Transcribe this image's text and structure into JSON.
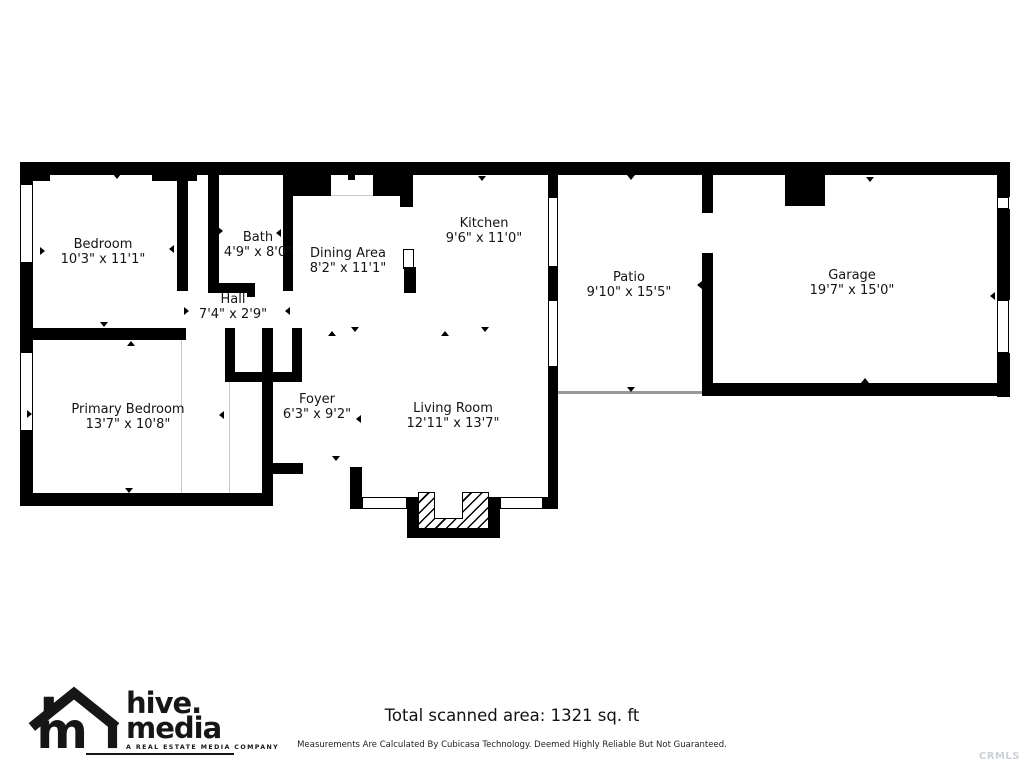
{
  "floorplan": {
    "rooms": [
      {
        "name": "Bedroom",
        "dims": "10'3\" x 11'1\""
      },
      {
        "name": "Bath",
        "dims": "4'9\" x 8'0\""
      },
      {
        "name": "Hall",
        "dims": "7'4\" x 2'9\""
      },
      {
        "name": "Dining Area",
        "dims": "8'2\" x 11'1\""
      },
      {
        "name": "Kitchen",
        "dims": "9'6\" x 11'0\""
      },
      {
        "name": "Patio",
        "dims": "9'10\" x 15'5\""
      },
      {
        "name": "Garage",
        "dims": "19'7\" x 15'0\""
      },
      {
        "name": "Primary Bedroom",
        "dims": "13'7\" x 10'8\""
      },
      {
        "name": "Foyer",
        "dims": "6'3\" x 9'2\""
      },
      {
        "name": "Living Room",
        "dims": "12'11\" x 13'7\""
      }
    ],
    "markers": [
      [
        113,
        174,
        "d"
      ],
      [
        100,
        322,
        "d"
      ],
      [
        127,
        341,
        "u"
      ],
      [
        40,
        247,
        "r"
      ],
      [
        169,
        245,
        "l"
      ],
      [
        218,
        227,
        "r"
      ],
      [
        276,
        229,
        "l"
      ],
      [
        246,
        286,
        "u"
      ],
      [
        184,
        307,
        "r"
      ],
      [
        285,
        307,
        "l"
      ],
      [
        478,
        176,
        "d"
      ],
      [
        328,
        331,
        "u"
      ],
      [
        351,
        327,
        "d"
      ],
      [
        441,
        331,
        "u"
      ],
      [
        481,
        327,
        "d"
      ],
      [
        627,
        175,
        "d"
      ],
      [
        627,
        387,
        "d"
      ],
      [
        697,
        281,
        "l"
      ],
      [
        866,
        177,
        "d"
      ],
      [
        990,
        292,
        "l"
      ],
      [
        861,
        378,
        "u"
      ],
      [
        27,
        410,
        "r"
      ],
      [
        219,
        411,
        "l"
      ],
      [
        125,
        488,
        "d"
      ],
      [
        332,
        456,
        "d"
      ],
      [
        356,
        415,
        "l"
      ],
      [
        445,
        528,
        "u"
      ]
    ]
  },
  "footer": {
    "total_area": "Total scanned area: 1321 sq. ft",
    "disclaimer": "Measurements Are Calculated By Cubicasa Technology. Deemed Highly Reliable But Not Guaranteed.",
    "watermark": "CRMLS"
  },
  "logo": {
    "line1": "hive.",
    "line2": "media",
    "tagline": "A REAL ESTATE MEDIA COMPANY"
  },
  "colors": {
    "wall": "#000000",
    "background": "#ffffff",
    "open_boundary": "#9a9a9a",
    "watermark": "#ccd1d6"
  }
}
